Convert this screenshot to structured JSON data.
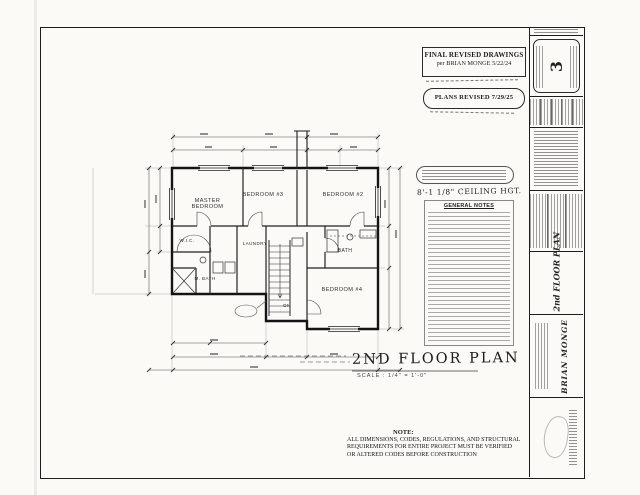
{
  "document": {
    "revisions": {
      "final_revised_line1": "FINAL REVISED DRAWINGS",
      "final_revised_line2": "per BRIAN MONGE  5/22/24",
      "plans_revised": "PLANS REVISED  7/29/25"
    },
    "plan_labels": {
      "master_bedroom": "MASTER BEDROOM",
      "bedroom_3": "BEDROOM #3",
      "bedroom_2": "BEDROOM #2",
      "bath": "BATH",
      "bedroom_4": "BEDROOM #4",
      "master_bath": "M. BATH",
      "wic": "W.I.C.",
      "laundry": "LAUNDRY",
      "stairs_dn": "DN"
    },
    "side_notes": {
      "ceiling_height": "8'-1 1/8\" CEILING HGT.",
      "general_notes_title": "GENERAL NOTES"
    },
    "drawing_title": {
      "text": "2ND FLOOR PLAN",
      "scale": "SCALE : 1/4\" = 1'-0\""
    },
    "note_block": {
      "heading": "NOTE:",
      "line1": "ALL DIMENSIONS, CODES, REGULATIONS, AND STRUCTURAL",
      "line2": "REQUIREMENTS FOR ENTIRE PROJECT MUST BE VERIFIED",
      "line3": "OR ALTERED CODES BEFORE CONSTRUCTION"
    },
    "title_block": {
      "sheet_number": "3",
      "sheet_title": "2nd FLOOR PLAN",
      "owner": "BRIAN MONGE"
    }
  }
}
